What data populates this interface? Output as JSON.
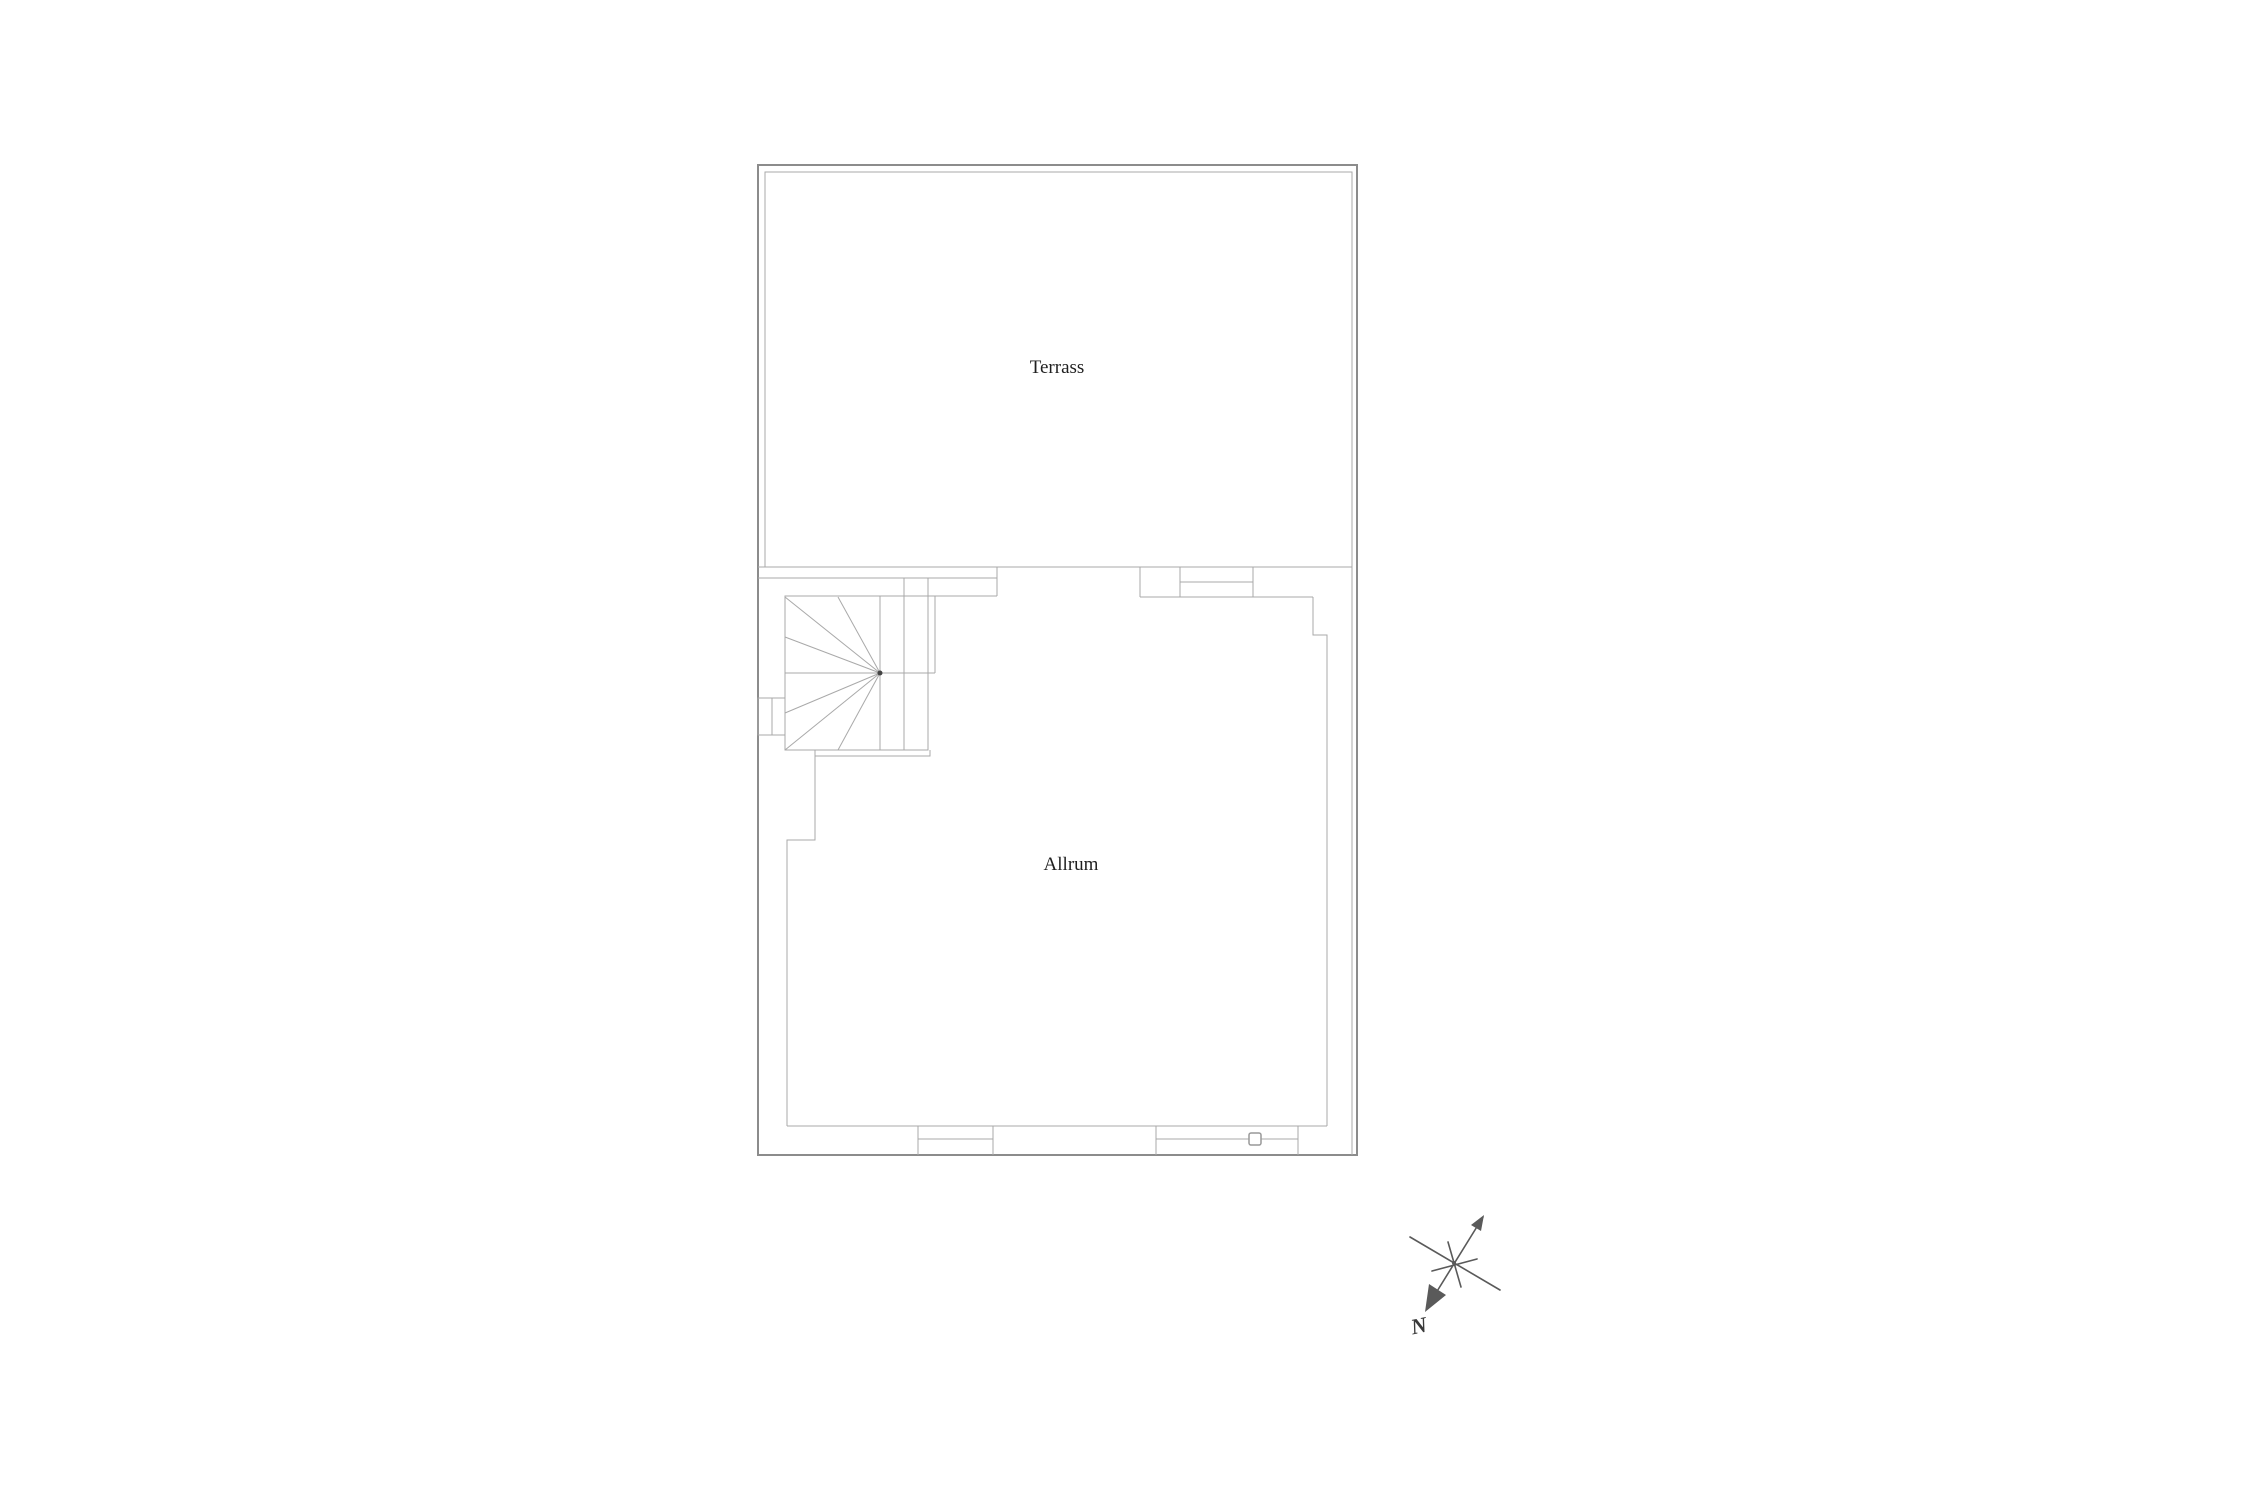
{
  "page": {
    "background_color": "#ffffff",
    "type": "floor-plan-drawing"
  },
  "plan": {
    "rooms": [
      {
        "label": "Terrass"
      },
      {
        "label": "Allrum"
      }
    ],
    "features": [
      "winder-staircase",
      "terrace-door",
      "bottom-window",
      "bottom-sliding-door"
    ],
    "compass": {
      "north_label": "N"
    },
    "colors": {
      "wall_outer": "#8c8c8c",
      "wall_inner": "#a9a9a9",
      "stair": "#a9a9a9",
      "text": "#1f1f1f",
      "compass": "#5a5a5a"
    }
  }
}
